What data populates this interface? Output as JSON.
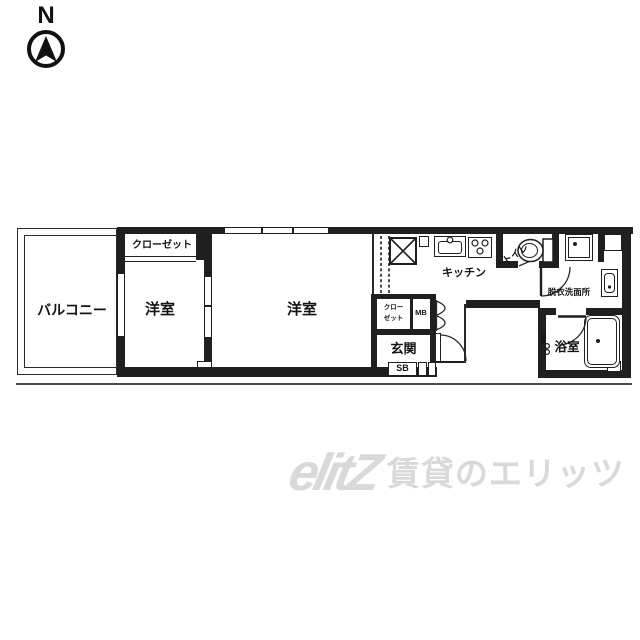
{
  "colors": {
    "line": "#1f1f1f",
    "watermark": "#d9d9d9",
    "background": "#ffffff"
  },
  "compass": {
    "north": "N"
  },
  "rooms": {
    "balcony": "バルコニー",
    "bedroom_left": "洋室",
    "bedroom_main": "洋室",
    "closet": "クローゼット",
    "kitchen": "キッチン",
    "toilet": "トイレ",
    "washroom": "脱衣洗面所",
    "bathroom": "浴室",
    "entrance": "玄関",
    "hall_closet_line1": "クロー",
    "hall_closet_line2": "ゼット",
    "shoe_box": "SB",
    "meter_box": "MB",
    "pipe_shaft": "PS"
  },
  "icons": {
    "north_arrow": "circle-with-north-needle",
    "refrigerator_space": "box-with-x",
    "sink": "basin-with-faucet-circle",
    "stove": "three-burner-circles",
    "toilet": "bowl-and-tank",
    "washer_pan": "double-square-with-dot",
    "vanity": "basin-with-dot",
    "bathtub": "rounded-tub-with-drain",
    "doors": "quarter-circle-swing-arcs"
  },
  "watermark": {
    "logo": "elitZ",
    "text": "賃貸のエリッツ"
  }
}
